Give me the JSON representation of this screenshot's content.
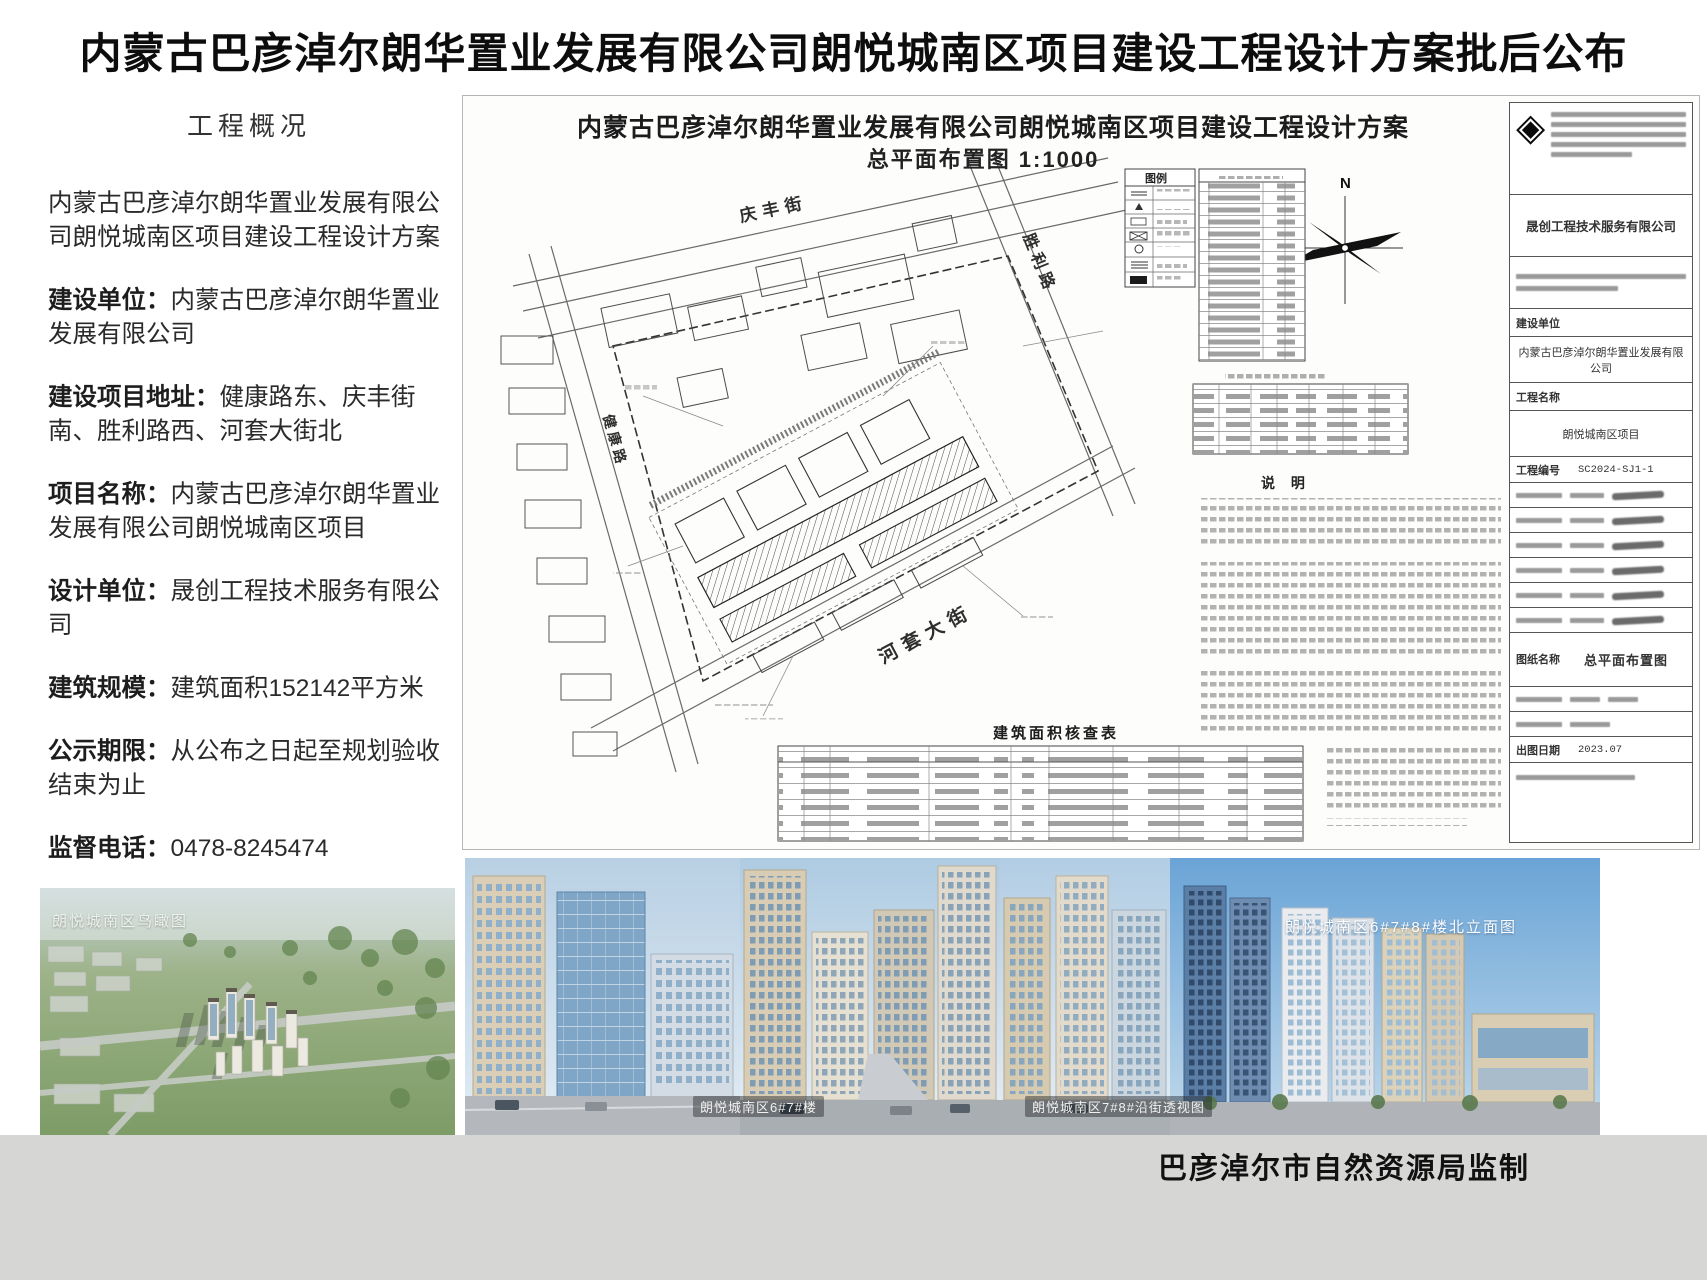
{
  "page": {
    "title": "内蒙古巴彦淖尔朗华置业发展有限公司朗悦城南区项目建设工程设计方案批后公布",
    "footer_credit": "巴彦淖尔市自然资源局监制"
  },
  "colors": {
    "footer_band": "#d6d6d5",
    "sky_blue": "#7fb0dc",
    "line_art": "#444444"
  },
  "overview": {
    "heading": "工程概况",
    "intro": "内蒙古巴彦淖尔朗华置业发展有限公司朗悦城南区项目建设工程设计方案",
    "fields": [
      {
        "label": "建设单位：",
        "value": "内蒙古巴彦淖尔朗华置业发展有限公司"
      },
      {
        "label": "建设项目地址：",
        "value": "健康路东、庆丰街南、胜利路西、河套大街北"
      },
      {
        "label": "项目名称：",
        "value": "内蒙古巴彦淖尔朗华置业发展有限公司朗悦城南区项目"
      },
      {
        "label": "设计单位：",
        "value": "晟创工程技术服务有限公司"
      },
      {
        "label": "建筑规模：",
        "value": "建筑面积152142平方米"
      },
      {
        "label": "公示期限：",
        "value": "从公布之日起至规划验收结束为止"
      },
      {
        "label": "监督电话：",
        "value": "0478-8245474"
      }
    ]
  },
  "drawing": {
    "title": "内蒙古巴彦淖尔朗华置业发展有限公司朗悦城南区项目建设工程设计方案",
    "subtitle": "总平面布置图  1:1000",
    "legend_title": "图例",
    "notes_title": "说 明",
    "area_table_title": "建筑面积核查表",
    "north_label": "N",
    "streets": {
      "north": "庆丰街",
      "east": "胜利路",
      "south": "河套大街",
      "west": "健康路"
    },
    "titleblock": {
      "company": "晟创工程技术服务有限公司",
      "owner_label": "建设单位",
      "owner": "内蒙古巴彦淖尔朗华置业发展有限公司",
      "project_label": "工程名称",
      "project": "朗悦城南区项目",
      "project_no_label": "工程编号",
      "project_no": "SC2024-SJ1-1",
      "drawing_name_label": "图纸名称",
      "drawing_name": "总平面布置图",
      "date_label": "出图日期",
      "date": "2023.07"
    }
  },
  "renderings": {
    "aerial_label": "朗悦城南区鸟瞰图",
    "street_view_label_1": "朗悦城南区6#7#楼",
    "street_view_label_2": "朗悦城南区7#8#沿街透视图",
    "elevation_label": "朗悦城南区6#7#8#楼北立面图"
  }
}
